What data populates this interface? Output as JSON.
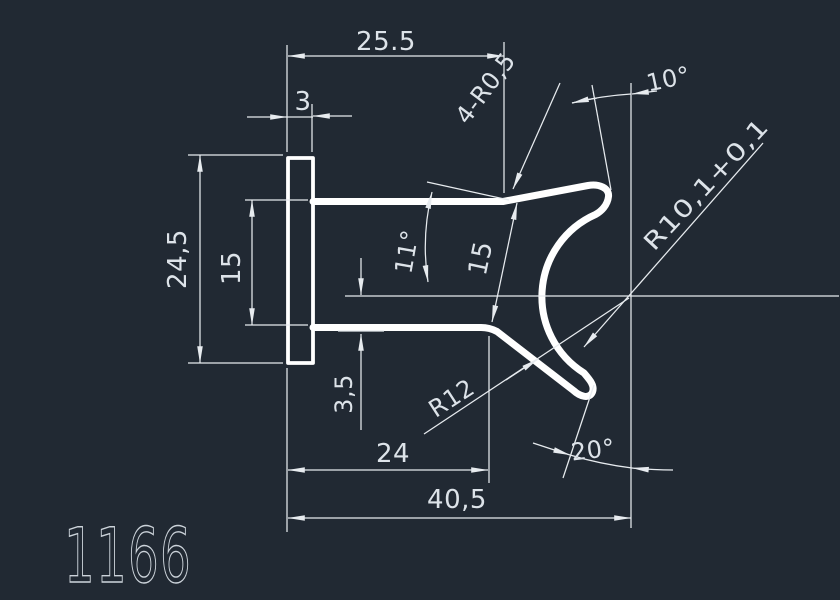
{
  "drawing_number": "1166",
  "colors": {
    "background": "#212933",
    "profile_line": "#ffffff",
    "dimension_line": "#e7ebef",
    "text": "#dde3e9"
  },
  "dimensions": {
    "top_width": "25.5",
    "flange_thickness": "3",
    "flange_height": "24,5",
    "arm_spacing": "15",
    "jaw_spacing": "15",
    "arm_angle": "11°",
    "fillet_radii": "4-R0,5",
    "top_tip_angle": "10°",
    "inner_radius": "R10,1+0,1",
    "outer_radius": "R12",
    "centerline_offset": "3,5",
    "lower_arm_length": "24",
    "overall_width": "40,5",
    "bottom_tip_angle": "20°"
  }
}
